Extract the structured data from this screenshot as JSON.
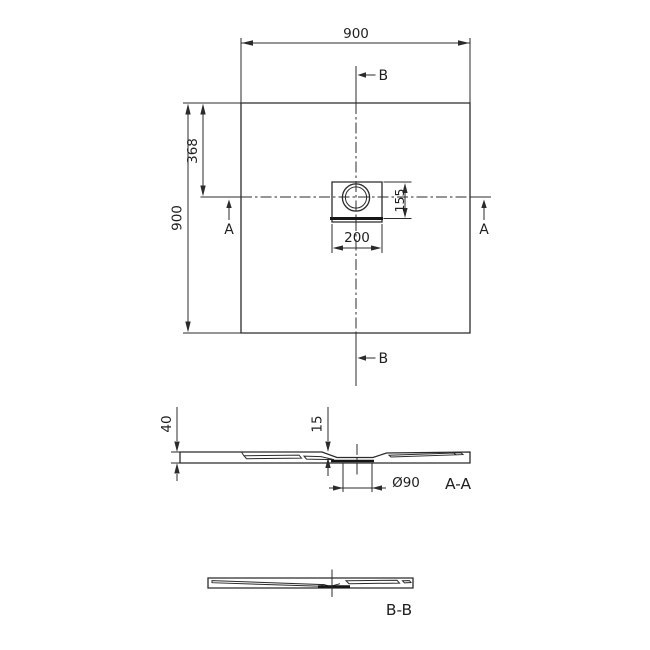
{
  "page": {
    "background": "#ffffff",
    "line_color": "#2b2b2b",
    "description": "Technical dimension drawing of a square shower tray with off-centre drain, plan view and two cross sections"
  },
  "plan_view": {
    "dim_width": "900",
    "dim_height": "900",
    "dim_drain_offset_y": "368",
    "dim_drain_cover_width": "200",
    "dim_drain_cover_height": "155",
    "section_marker_a": "A",
    "section_marker_b": "B"
  },
  "section_aa": {
    "label": "A-A",
    "dim_tray_height": "40",
    "dim_inner_depth": "15",
    "dim_drain_diameter": "Ø90"
  },
  "section_bb": {
    "label": "B-B"
  }
}
